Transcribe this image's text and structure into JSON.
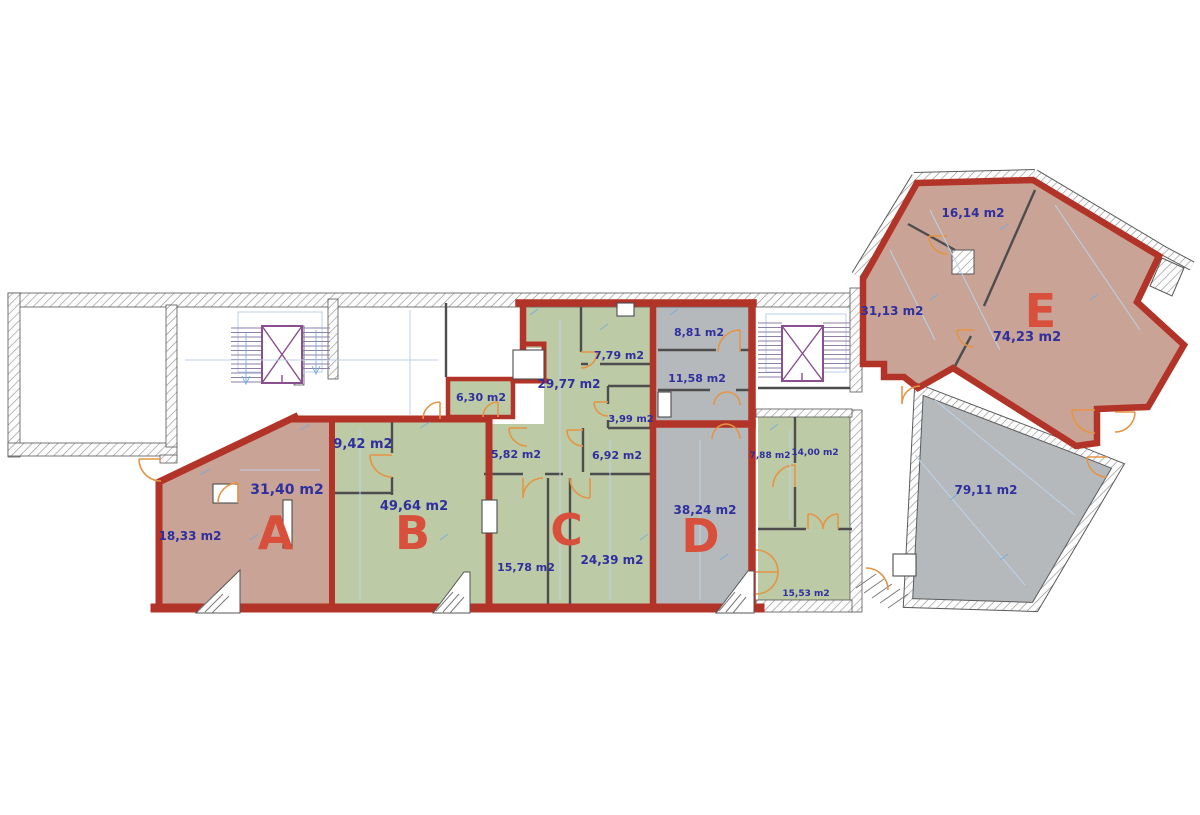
{
  "title": "Building floor plan with commercial units A-E",
  "palette": {
    "unit_outline_red": "#b23327",
    "unit_letter_red": "#d8503c",
    "area_text_blue": "#2f2f9e",
    "dimension_blue": "#6ea9dd",
    "door_orange": "#e49544",
    "stairs_purple": "#8a4f8f",
    "fill_tan": "#c9a396",
    "fill_green": "#bdcaa6",
    "fill_gray": "#b6b9bc"
  },
  "floorplan": {
    "units": [
      {
        "letter": "A"
      },
      {
        "letter": "B"
      },
      {
        "letter": "C"
      },
      {
        "letter": "D"
      },
      {
        "letter": "E"
      }
    ],
    "room_labels": [
      {
        "text": "31,40 m2"
      },
      {
        "text": "18,33 m2"
      },
      {
        "text": "9,42 m2"
      },
      {
        "text": "49,64 m2"
      },
      {
        "text": "6,30 m2"
      },
      {
        "text": "29,77 m2"
      },
      {
        "text": "7,79 m2"
      },
      {
        "text": "3,99 m2"
      },
      {
        "text": "5,82 m2"
      },
      {
        "text": "6,92 m2"
      },
      {
        "text": "15,78 m2"
      },
      {
        "text": "24,39 m2"
      },
      {
        "text": "8,81 m2"
      },
      {
        "text": "11,58 m2"
      },
      {
        "text": "38,24 m2"
      },
      {
        "text": "7,88 m2"
      },
      {
        "text": "14,00 m2"
      },
      {
        "text": "15,53 m2"
      },
      {
        "text": "16,14 m2"
      },
      {
        "text": "31,13 m2"
      },
      {
        "text": "74,23 m2"
      },
      {
        "text": "79,11 m2"
      }
    ]
  }
}
